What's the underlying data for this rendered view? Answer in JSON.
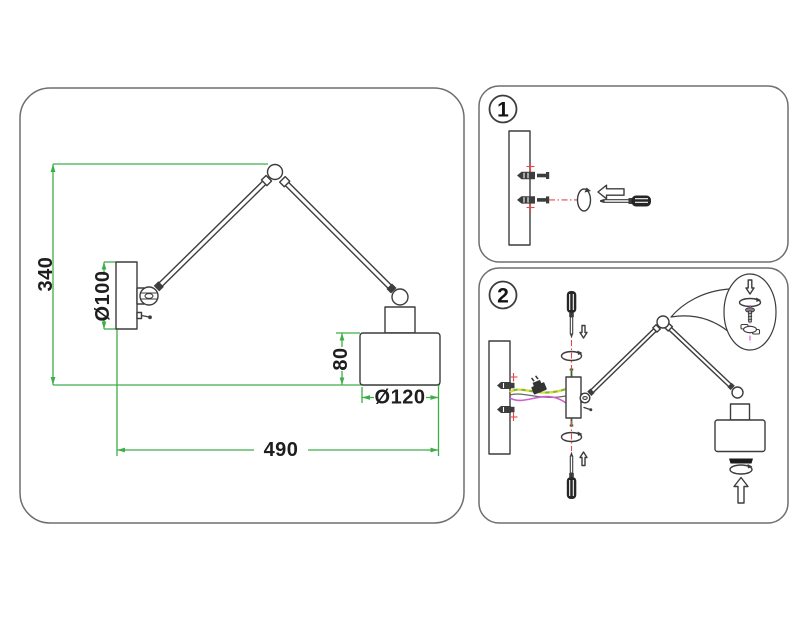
{
  "colors": {
    "line": "#3d3d3d",
    "panel_border": "#6f6f6f",
    "green": "#3fae49",
    "red": "#e84848",
    "magenta": "#cf5fd0",
    "wire_green": "#7ab832",
    "wire_yellow": "#e6d92e",
    "screw_green": "#35682d",
    "paper": "#ffffff"
  },
  "main_drawing": {
    "dim_height": "340",
    "dim_plate": "Ø100",
    "dim_shade_height": "80",
    "dim_shade_width": "Ø120",
    "dim_reach": "490"
  },
  "steps": [
    {
      "number": "1"
    },
    {
      "number": "2"
    }
  ]
}
